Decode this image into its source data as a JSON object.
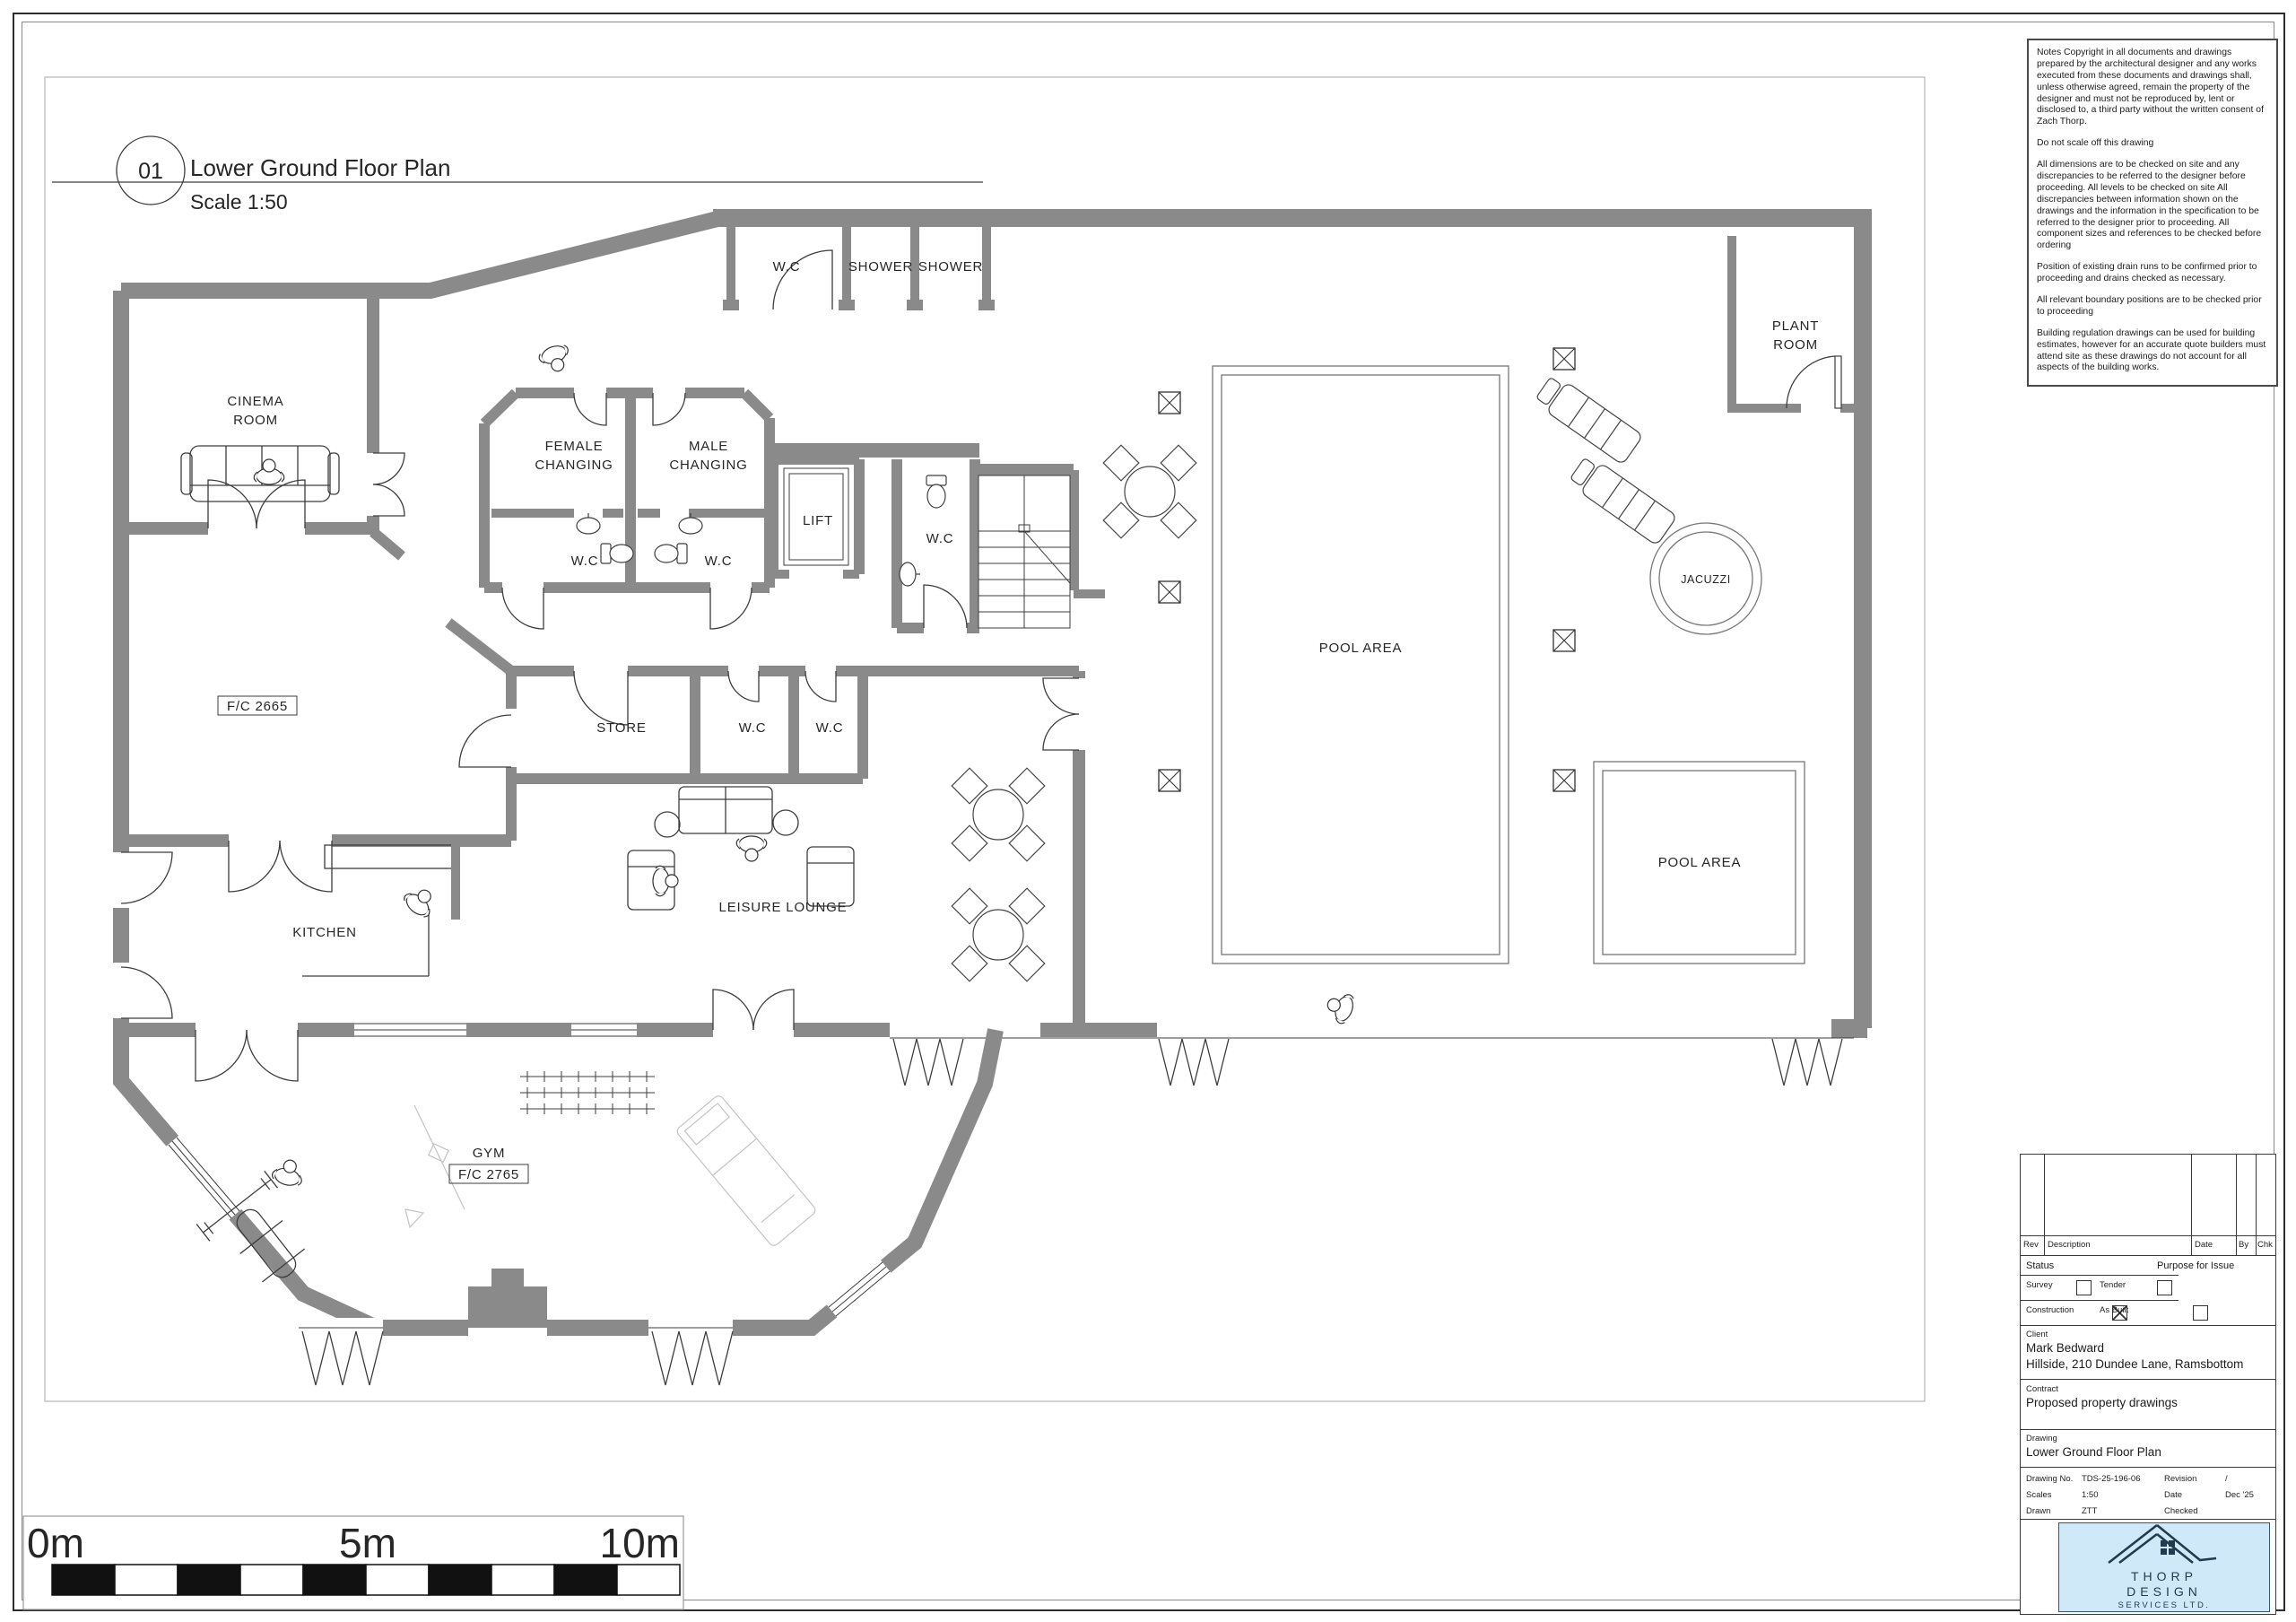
{
  "sheet": {
    "detail_number": "01",
    "title": "Lower Ground Floor Plan",
    "scale_note": "Scale 1:50"
  },
  "notes": {
    "paragraphs": [
      "Notes Copyright in all documents and drawings prepared by the architectural designer and any works executed from these documents and drawings shall, unless otherwise agreed, remain the property of the designer and must not be reproduced by, lent or disclosed to, a third party without the written consent of Zach Thorp.",
      "Do not scale off this drawing",
      "All dimensions are to be checked on site and any discrepancies to be referred to the designer before proceeding. All levels to be checked on site All discrepancies between information shown on the drawings and the information in the specification to be referred to the designer prior to proceeding. All component sizes and references to be checked before ordering",
      "Position of existing drain runs to be confirmed prior to proceeding and drains checked as necessary.",
      "All relevant boundary positions are to be checked prior to proceeding",
      "Building regulation drawings can be used for building estimates, however for an accurate quote builders must attend site as these drawings do not account for all aspects of the building works."
    ]
  },
  "revision_table": {
    "headers": [
      "Rev",
      "Description",
      "Date",
      "By",
      "Chk"
    ]
  },
  "status": {
    "label": "Status",
    "purpose_label": "Purpose for Issue",
    "options": [
      {
        "label": "Survey",
        "checked": false
      },
      {
        "label": "Tender",
        "checked": false
      },
      {
        "label": "Construction",
        "checked": true
      },
      {
        "label": "As Built",
        "checked": false
      }
    ]
  },
  "client": {
    "label": "Client",
    "name": "Mark Bedward",
    "address": "Hillside, 210 Dundee Lane, Ramsbottom"
  },
  "contract": {
    "label": "Contract",
    "value": "Proposed property drawings"
  },
  "drawing": {
    "label": "Drawing",
    "value": "Lower Ground Floor Plan"
  },
  "info": {
    "rows": [
      {
        "label": "Drawing No.",
        "value": "TDS-25-196-06",
        "label2": "Revision",
        "value2": "/"
      },
      {
        "label": "Scales",
        "value": "1:50",
        "label2": "Date",
        "value2": "Dec '25"
      },
      {
        "label": "Drawn",
        "value": "ZTT",
        "label2": "Checked",
        "value2": ""
      }
    ]
  },
  "logo": {
    "line1": "THORP",
    "line2": "DESIGN",
    "line3": "SERVICES LTD.",
    "bg_color": "#cfe9f8",
    "ink_color": "#243b4f"
  },
  "scale_bar": {
    "labels": [
      "0m",
      "5m",
      "10m"
    ]
  },
  "plan": {
    "wall_color": "#8a8a8a",
    "labels": [
      "CINEMA",
      "ROOM",
      "FEMALE",
      "CHANGING",
      "MALE",
      "CHANGING",
      "W.C",
      "SHOWER",
      "SHOWER",
      "LIFT",
      "W.C",
      "PLANT",
      "ROOM",
      "JACUZZI",
      "POOL AREA",
      "POOL AREA",
      "STORE",
      "W.C",
      "W.C",
      "W.C",
      "W.C",
      "KITCHEN",
      "LEISURE LOUNGE",
      "GYM",
      "F/C 2665",
      "F/C 2765"
    ]
  }
}
